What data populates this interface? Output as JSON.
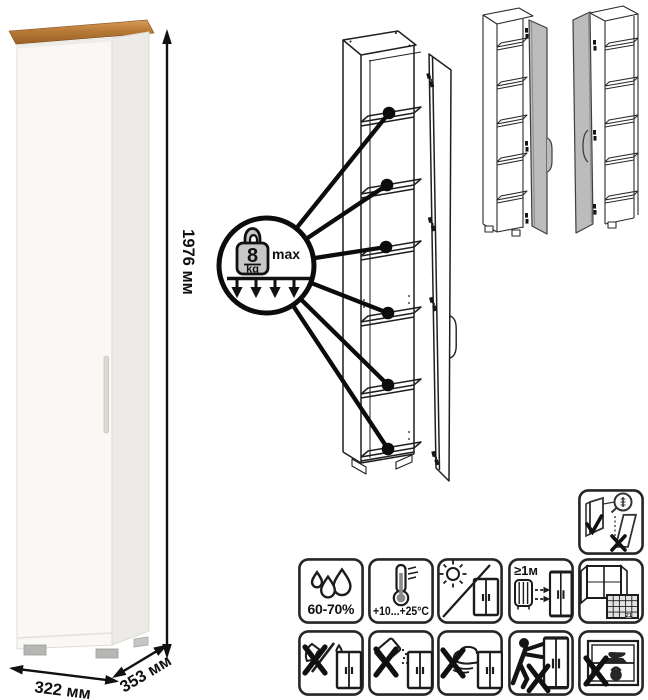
{
  "page": {
    "background": "#ffffff"
  },
  "dimensions": {
    "height": "1976 мм",
    "width": "322 мм",
    "depth": "353 мм"
  },
  "load_limit": {
    "value": "8",
    "unit": "kg",
    "qualifier": "max",
    "shelves_indicated": 6
  },
  "care": {
    "humidity": "60-70%",
    "temperature": "+10...+25°C",
    "distance": "≥1м",
    "calendar_day": "21"
  },
  "palette": {
    "wood_top": "#b87a36",
    "cabinet_front": "#f9f8f5",
    "cabinet_side": "#ecebe7",
    "variant_door_gray": "#bcbcbc",
    "line_art": "#1f1f1f"
  }
}
